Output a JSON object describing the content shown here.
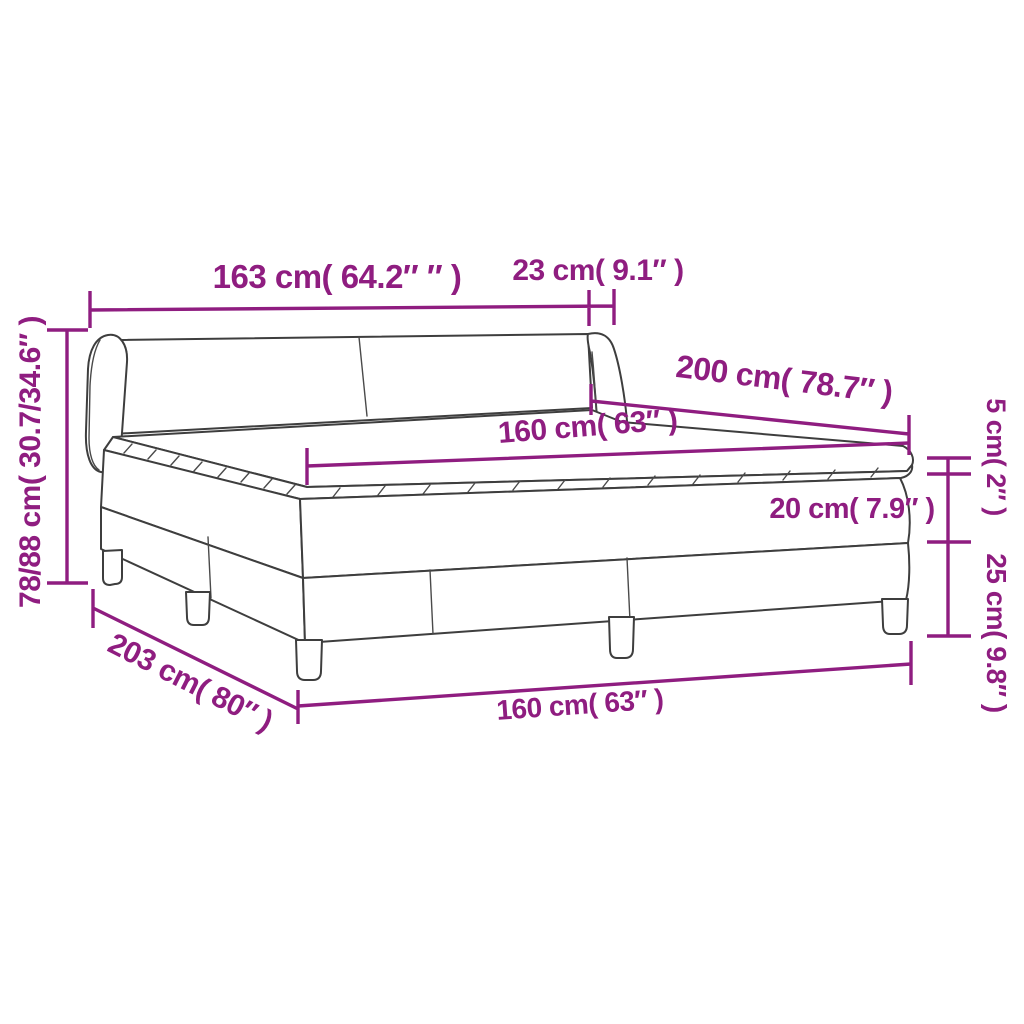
{
  "diagram": {
    "title": "box-spring-bed-dimension-diagram",
    "colors": {
      "dimension_accent": "#8F1D80",
      "drawing_outline": "#3E3E3E",
      "background": "#FFFFFF"
    },
    "labels": {
      "headboard_width": "163 cm( 64.2″ ″ )",
      "wing_depth": "23 cm( 9.1″ )",
      "bed_height": "78/88 cm( 30.7/34.6″ )",
      "bed_length": "200 cm( 78.7″ )",
      "mattress_width": "160 cm( 63″ )",
      "topper_height": "5 cm( 2″ )",
      "mattress_height": "20 cm( 7.9″ )",
      "base_height": "25 cm( 9.8″ )",
      "total_length": "203 cm( 80″ )",
      "base_width": "160 cm( 63″ )"
    }
  }
}
